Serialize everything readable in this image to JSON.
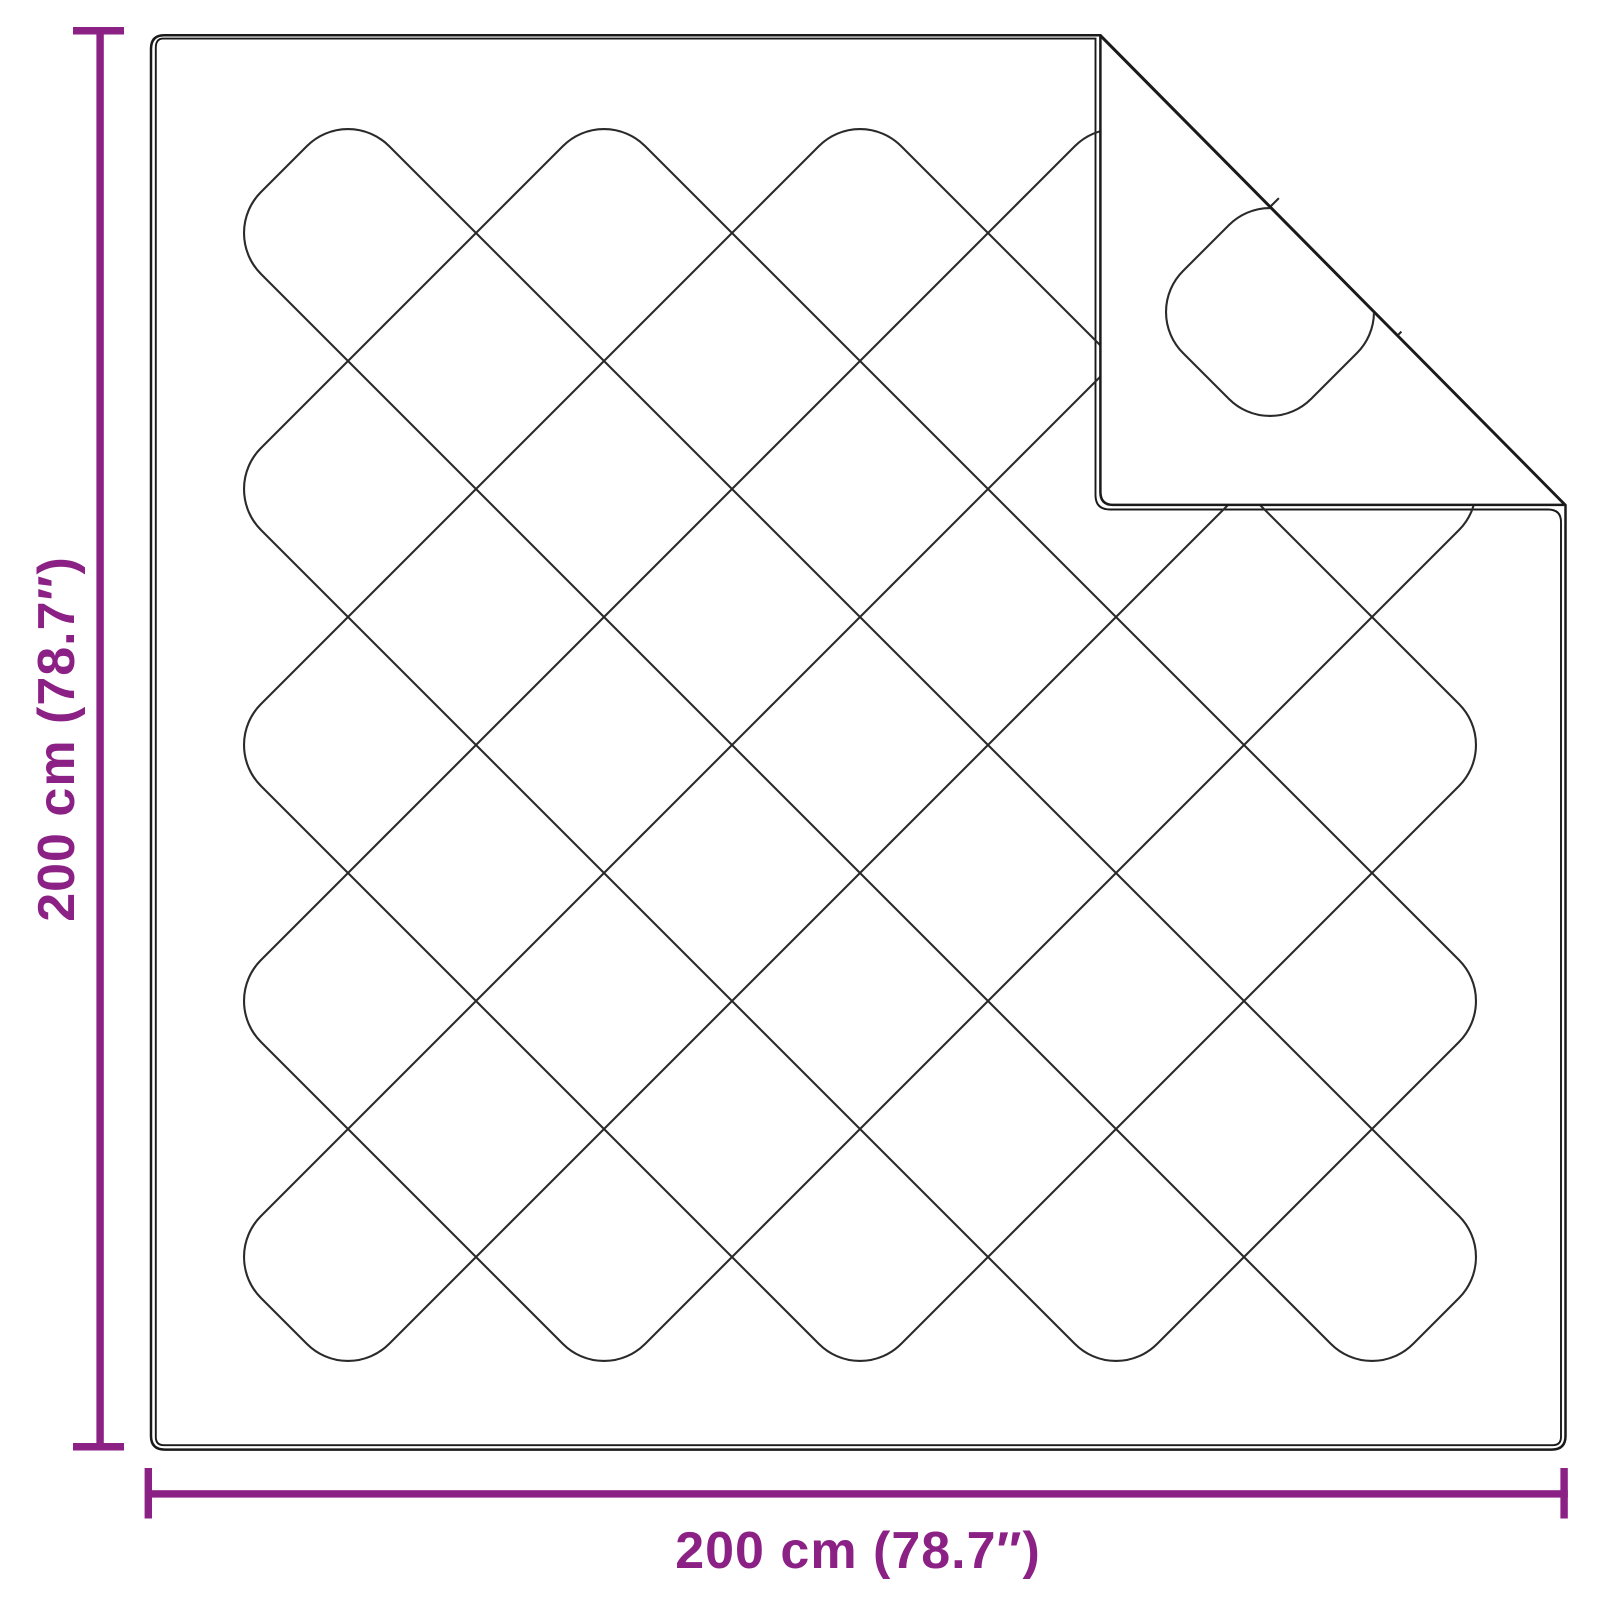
{
  "diagram": {
    "title": "duvet-dimension-diagram",
    "labels": {
      "height": "200 cm (78.7″)",
      "width": "200 cm (78.7″)"
    },
    "colors": {
      "dimension_accent": "#8B2085",
      "outline": "#1a1a1a",
      "quilt_pattern": "#2a2a2a",
      "background": "#ffffff"
    }
  }
}
